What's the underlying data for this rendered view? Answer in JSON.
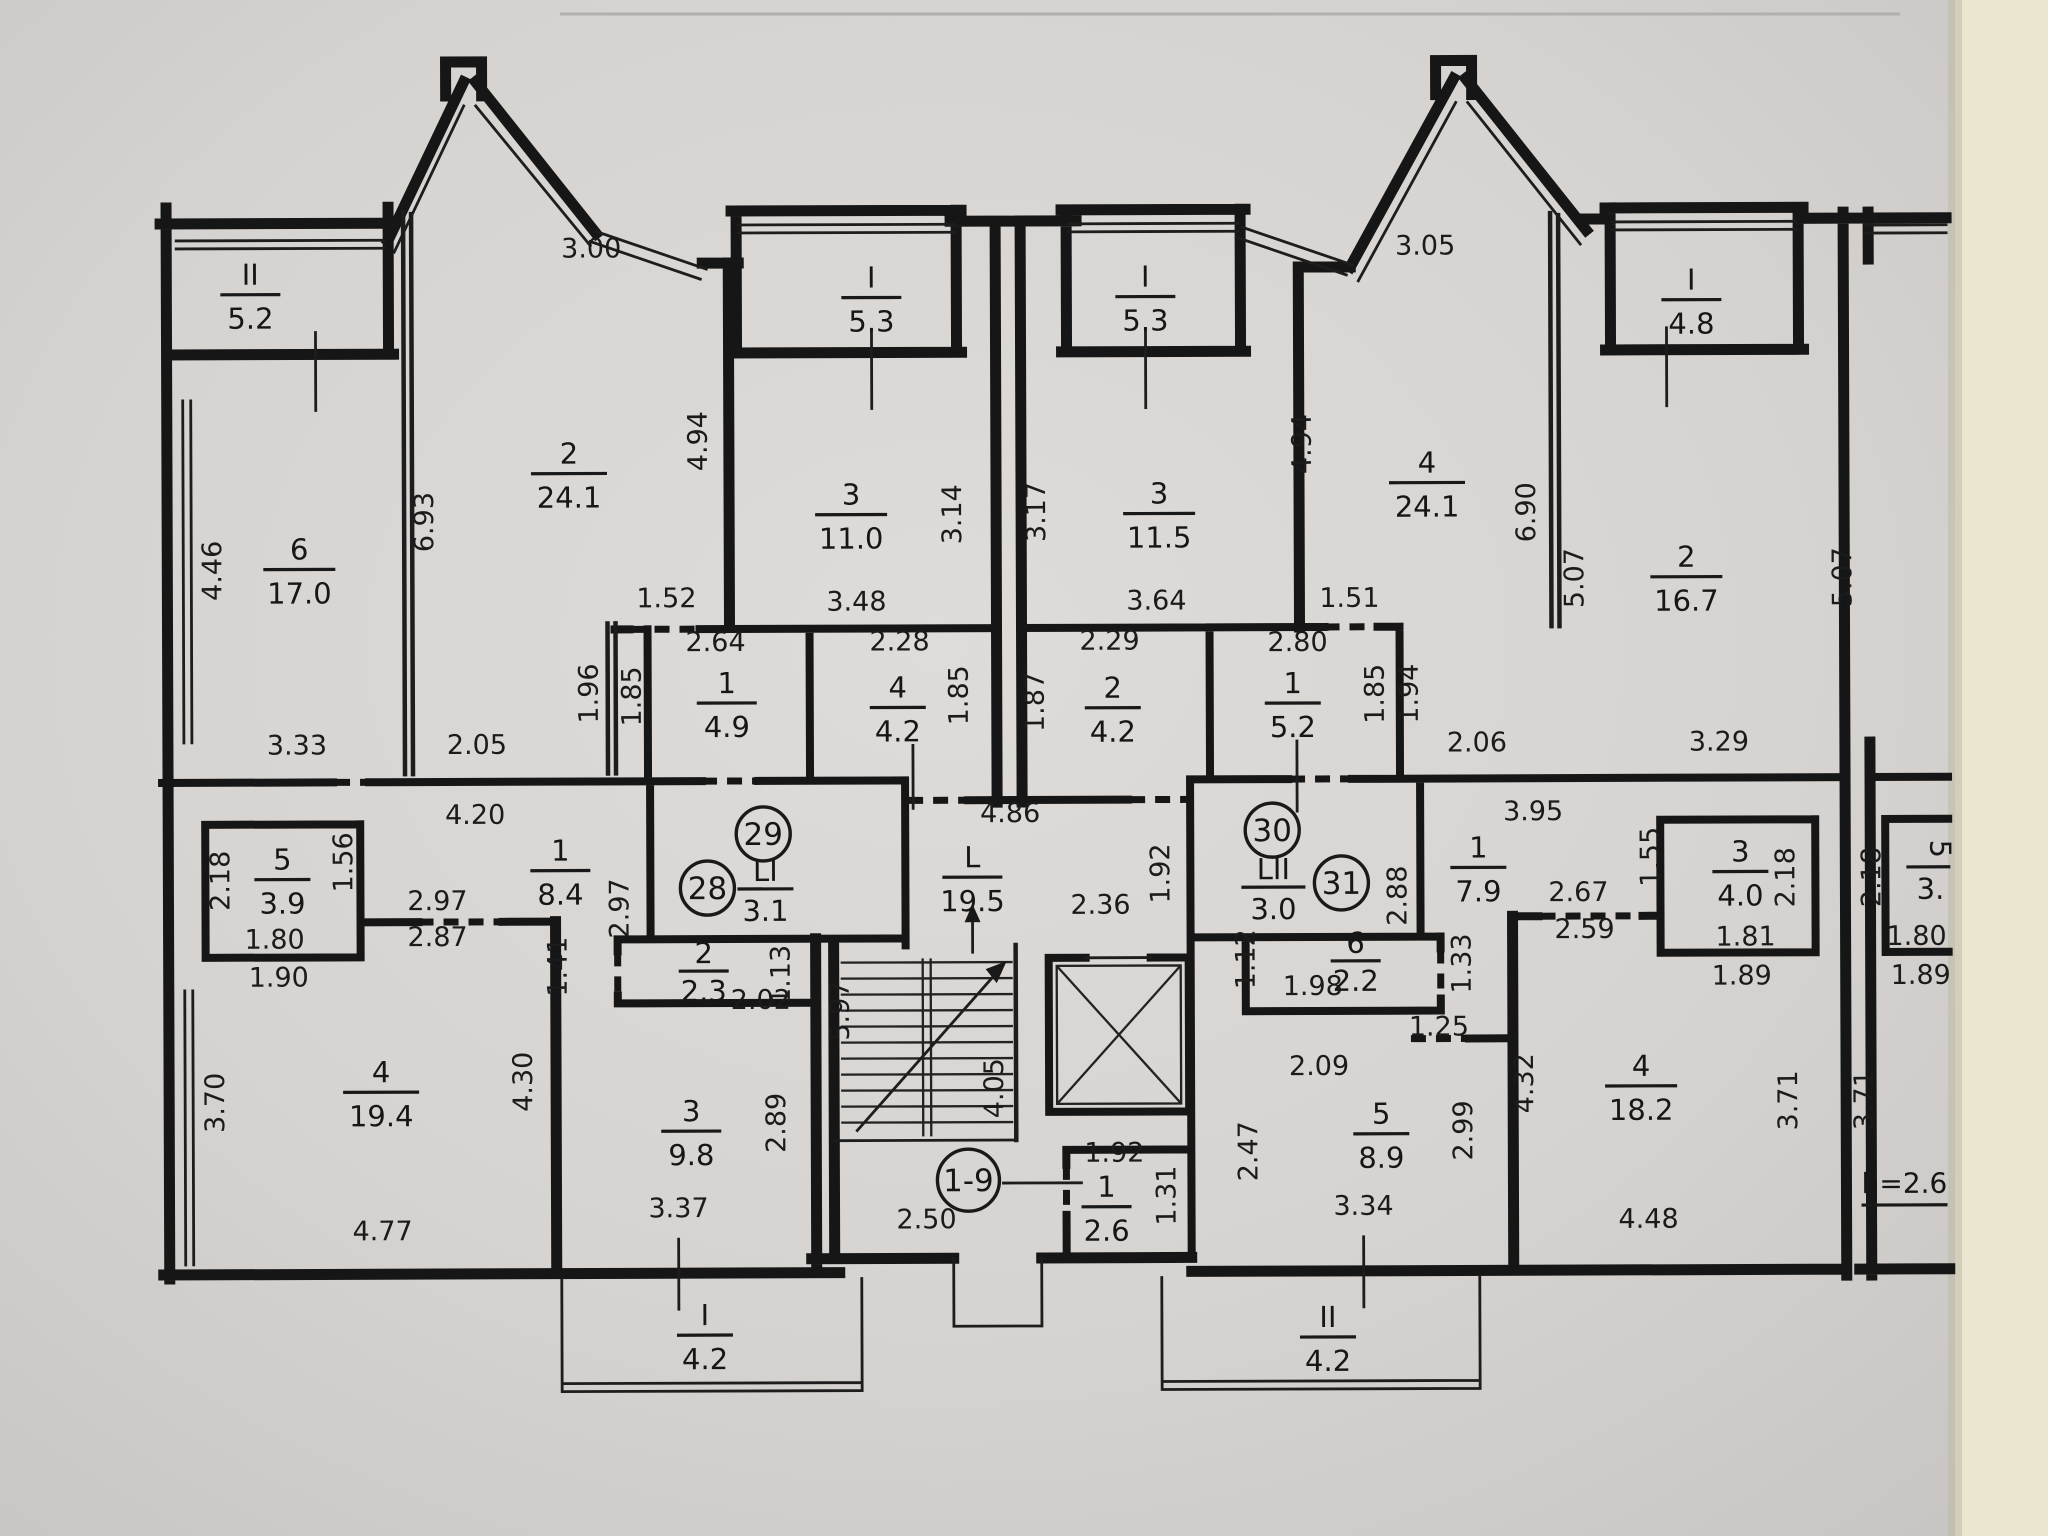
{
  "document": {
    "kind": "scanned floor plan photo",
    "height_note": "h=2.6",
    "stairs_range": "1-9",
    "colors": {
      "paper": "#d7d4d1",
      "background": "#eae6cf",
      "ink": "#1a1a1a"
    }
  },
  "apartments": {
    "a28": "28",
    "a29": "29",
    "a30": "30",
    "a31": "31"
  },
  "rooms": {
    "bal52": {
      "n": "II",
      "a": "5.2"
    },
    "r6_170": {
      "n": "6",
      "a": "17.0"
    },
    "r2_241": {
      "n": "2",
      "a": "24.1"
    },
    "bal53L": {
      "n": "I",
      "a": "5.3"
    },
    "r3_110": {
      "n": "3",
      "a": "11.0"
    },
    "r1_49": {
      "n": "1",
      "a": "4.9"
    },
    "r4_42": {
      "n": "4",
      "a": "4.2"
    },
    "r1_84": {
      "n": "1",
      "a": "8.4"
    },
    "r5_39": {
      "n": "5",
      "a": "3.9"
    },
    "r2_23": {
      "n": "2",
      "a": "2.3"
    },
    "r4_194": {
      "n": "4",
      "a": "19.4"
    },
    "r3_98": {
      "n": "3",
      "a": "9.8"
    },
    "bal42L": {
      "n": "I",
      "a": "4.2"
    },
    "li": {
      "n": "LI",
      "a": "3.1"
    },
    "hall": {
      "n": "L",
      "a": "19.5"
    },
    "r1_26": {
      "n": "1",
      "a": "2.6"
    },
    "bal53R": {
      "n": "I",
      "a": "5.3"
    },
    "r3_115": {
      "n": "3",
      "a": "11.5"
    },
    "r2_42R": {
      "n": "2",
      "a": "4.2"
    },
    "r1_52": {
      "n": "1",
      "a": "5.2"
    },
    "r4_241R": {
      "n": "4",
      "a": "24.1"
    },
    "bal48": {
      "n": "I",
      "a": "4.8"
    },
    "r2_167": {
      "n": "2",
      "a": "16.7"
    },
    "lii": {
      "n": "LII",
      "a": "3.0"
    },
    "r1_79": {
      "n": "1",
      "a": "7.9"
    },
    "r6_22": {
      "n": "6",
      "a": "2.2"
    },
    "r5_89": {
      "n": "5",
      "a": "8.9"
    },
    "r4_182": {
      "n": "4",
      "a": "18.2"
    },
    "r3_40": {
      "n": "3",
      "a": "4.0"
    },
    "bal42R": {
      "n": "II",
      "a": "4.2"
    },
    "next_partial": {
      "n": "5",
      "a": "3."
    }
  },
  "dims": {
    "d300": "3.00",
    "d305": "3.05",
    "d446": "4.46",
    "d693": "6.93",
    "d494l": "4.94",
    "d494r": "4.94",
    "d314": "3.14",
    "d317": "3.17",
    "d690": "6.90",
    "d507a": "5.07",
    "d507b": "5.07",
    "d152": "1.52",
    "d264": "2.64",
    "d348": "3.48",
    "d228": "2.28",
    "d196": "1.96",
    "d185a": "1.85",
    "d185b": "1.85",
    "d185c": "1.85",
    "d194": "1.94",
    "d364": "3.64",
    "d229": "2.29",
    "d187": "1.87",
    "d151": "1.51",
    "d280": "2.80",
    "d206": "2.06",
    "d329": "3.29",
    "d333": "3.33",
    "d205": "2.05",
    "d420": "4.20",
    "d297a": "2.97",
    "d297b": "2.97",
    "d287": "2.87",
    "d218a": "2.18",
    "d218b": "2.18",
    "d218c": "2.18",
    "d156": "1.56",
    "d155": "1.55",
    "d180a": "1.80",
    "d180b": "1.80",
    "d190": "1.90",
    "d189a": "1.89",
    "d189b": "1.89",
    "d181": "1.81",
    "d141": "1.41",
    "d202": "2.02",
    "d113": "1.13",
    "d486": "4.86",
    "d192a": "1.92",
    "d192b": "1.92",
    "d236": "2.36",
    "d395": "3.95",
    "d288": "2.88",
    "d112": "1.12",
    "d198": "1.98",
    "d133": "1.33",
    "d267": "2.67",
    "d259": "2.59",
    "d125": "1.25",
    "d209": "2.09",
    "d370": "3.70",
    "d371a": "3.71",
    "d371b": "3.71",
    "d430": "4.30",
    "d432": "4.32",
    "d289": "2.89",
    "d299": "2.99",
    "d247": "2.47",
    "d597": "5.97",
    "d405": "4.05",
    "d477": "4.77",
    "d337": "3.37",
    "d334": "3.34",
    "d448": "4.48",
    "d250": "2.50",
    "d131": "1.31"
  },
  "notes": {
    "height": "h=2.6",
    "stairs": "1-9"
  }
}
